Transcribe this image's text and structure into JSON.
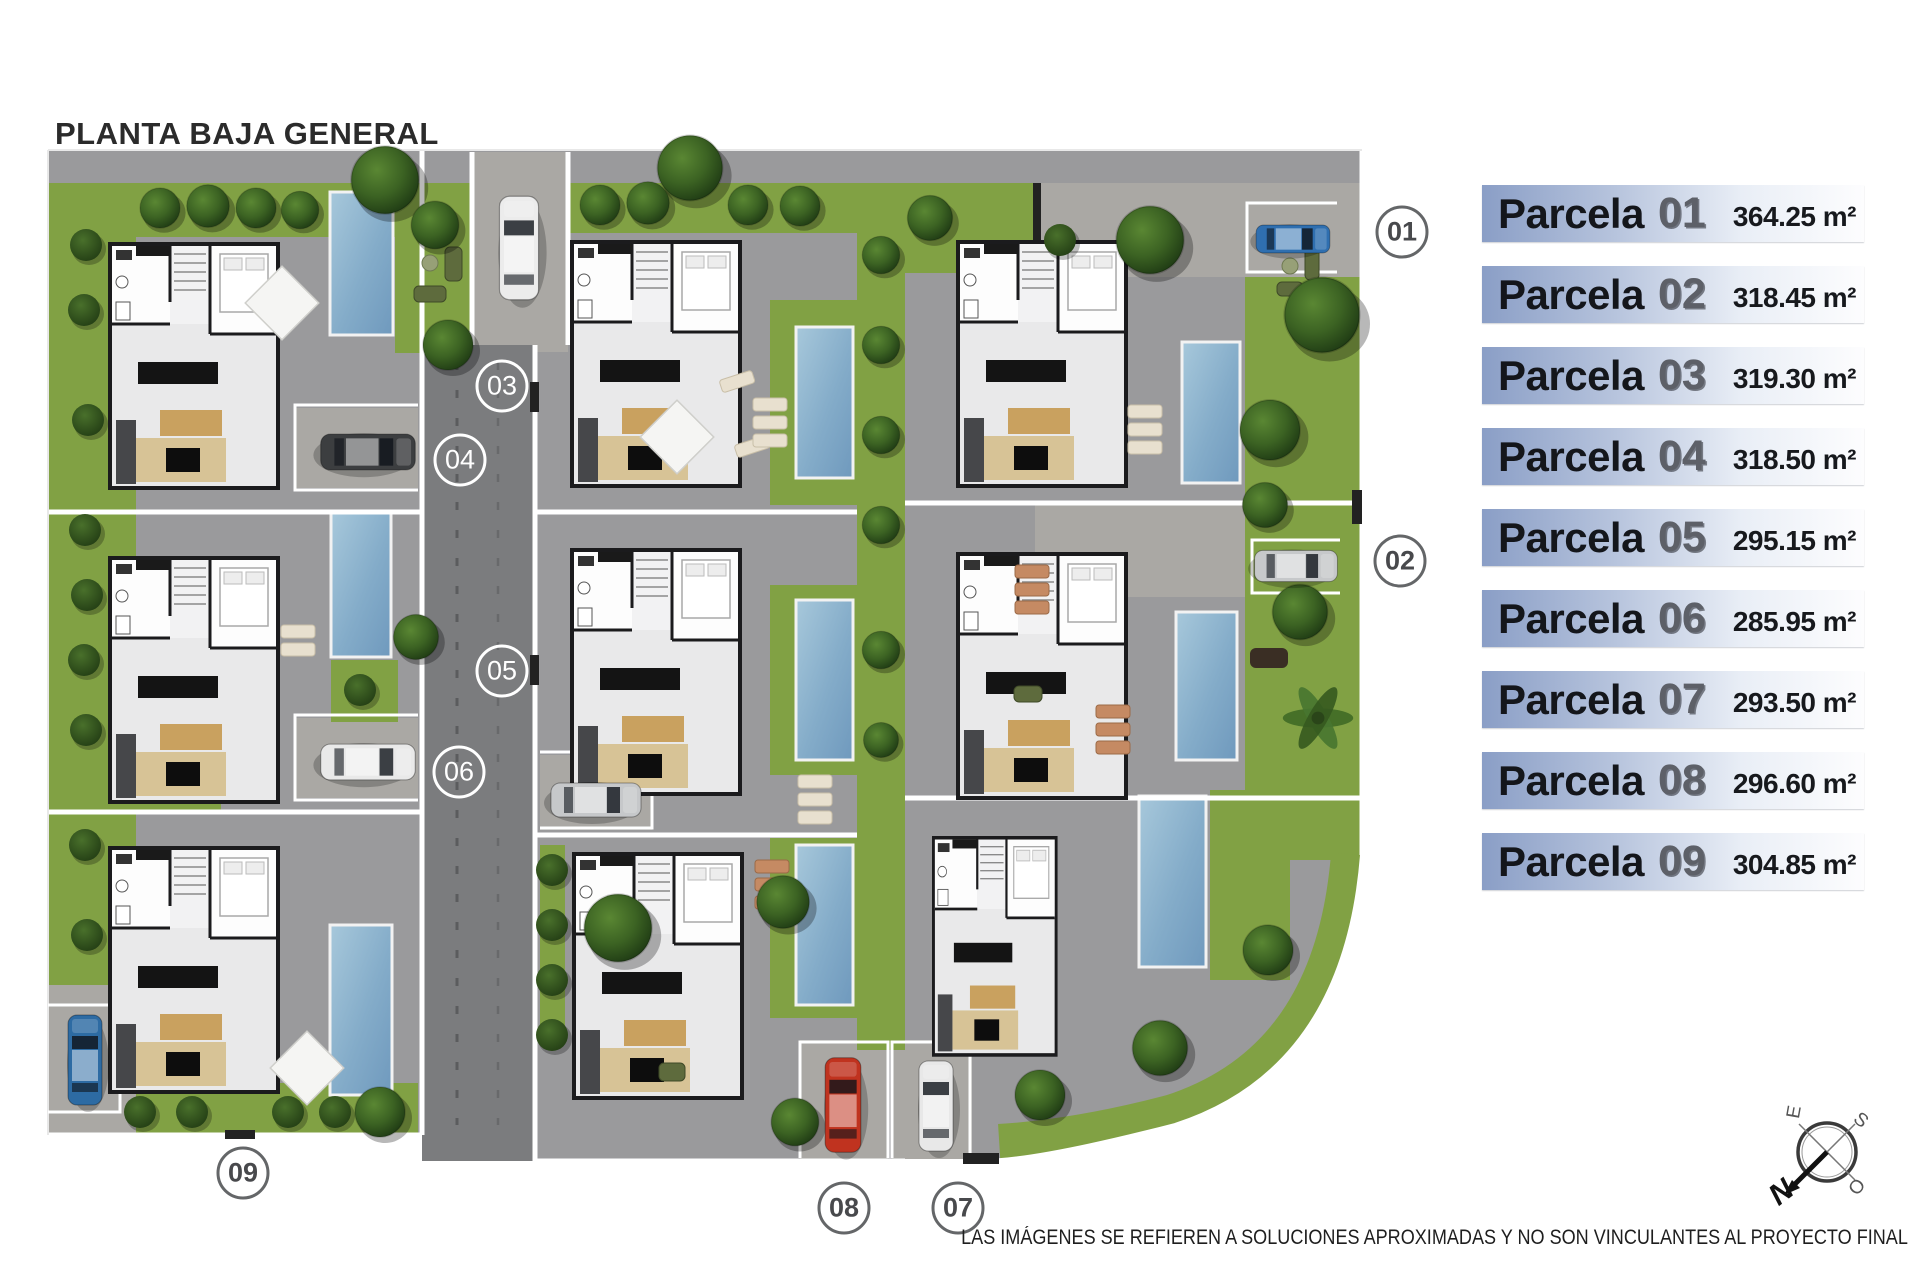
{
  "title": "PLANTA BAJA GENERAL",
  "legend": {
    "items": [
      {
        "name": "Parcela",
        "num": "01",
        "area": "364.25 m²"
      },
      {
        "name": "Parcela",
        "num": "02",
        "area": "318.45 m²"
      },
      {
        "name": "Parcela",
        "num": "03",
        "area": "319.30 m²"
      },
      {
        "name": "Parcela",
        "num": "04",
        "area": "318.50 m²"
      },
      {
        "name": "Parcela",
        "num": "05",
        "area": "295.15 m²"
      },
      {
        "name": "Parcela",
        "num": "06",
        "area": "285.95 m²"
      },
      {
        "name": "Parcela",
        "num": "07",
        "area": "293.50 m²"
      },
      {
        "name": "Parcela",
        "num": "08",
        "area": "296.60 m²"
      },
      {
        "name": "Parcela",
        "num": "09",
        "area": "304.85 m²"
      }
    ]
  },
  "plan": {
    "markers": [
      {
        "label": "01"
      },
      {
        "label": "02"
      },
      {
        "label": "03"
      },
      {
        "label": "04"
      },
      {
        "label": "05"
      },
      {
        "label": "06"
      },
      {
        "label": "07"
      },
      {
        "label": "08"
      },
      {
        "label": "09"
      }
    ]
  },
  "compass": {
    "north": "N",
    "east": "E",
    "south": "S",
    "west": "O"
  },
  "disclaimer": "LAS IMÁGENES SE REFIEREN A SOLUCIONES APROXIMADAS Y NO SON VINCULANTES AL PROYECTO FINAL",
  "colors": {
    "lawn": "#81a144",
    "road": "#7b7c7e",
    "parcel_ground": "#9a9a9c",
    "paver": "#aaa8a4",
    "pool": "#8fb3cf",
    "legend_blue": "#8a9ec6",
    "marker_light": "#ffffff",
    "marker_dark_border": "#646668"
  }
}
